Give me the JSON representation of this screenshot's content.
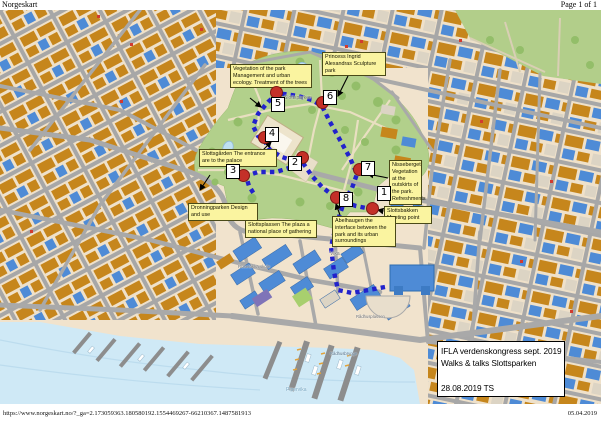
{
  "page": {
    "app_title": "Norgeskart",
    "page_indicator": "Page 1 of 1",
    "footer_url": "https://www.norgeskart.no/?_ga=2.173059363.180580192.1554469267-66210367.1487581913",
    "footer_date": "05.04.2019"
  },
  "legend": {
    "lines": [
      "IFLA verdenskongress sept. 2019",
      "Walks & talks Slottsparken",
      "",
      "28.08.2019 TS"
    ]
  },
  "map": {
    "markers": [
      {
        "number": "1",
        "circle": [
          372,
          198
        ],
        "box": [
          384,
          184
        ]
      },
      {
        "number": "2",
        "circle": [
          302,
          147
        ],
        "box": [
          295,
          154
        ]
      },
      {
        "number": "3",
        "circle": [
          243,
          165
        ],
        "box": [
          233,
          162
        ]
      },
      {
        "number": "4",
        "circle": [
          264,
          127
        ],
        "box": [
          272,
          125
        ]
      },
      {
        "number": "5",
        "circle": [
          276,
          82
        ],
        "box": [
          278,
          95
        ]
      },
      {
        "number": "6",
        "circle": [
          322,
          92
        ],
        "box": [
          330,
          88
        ]
      },
      {
        "number": "7",
        "circle": [
          359,
          159
        ],
        "box": [
          368,
          159
        ]
      },
      {
        "number": "8",
        "circle": [
          336,
          187
        ],
        "box": [
          346,
          190
        ]
      }
    ],
    "annotations": [
      {
        "id": "vegetation-of-the-park",
        "x": 230,
        "y": 54,
        "w": 82,
        "text": "Vegetation of the park Management and urban ecology.  Treatment of the trees"
      },
      {
        "id": "princess-ingrid",
        "x": 322,
        "y": 42,
        "w": 64,
        "text": "Princess Ingrid Alexandras Sculpture park"
      },
      {
        "id": "slottsgarden",
        "x": 199,
        "y": 139,
        "w": 78,
        "text": "Slottsgården The entrance are to the palace"
      },
      {
        "id": "dronningparken",
        "x": 188,
        "y": 193,
        "w": 70,
        "text": "Dronningparken Design and use"
      },
      {
        "id": "nisseberget",
        "x": 389,
        "y": 150,
        "w": 33,
        "text": "Nisseberget Vegetation at the outskirts of the park. Refreshments"
      },
      {
        "id": "slottsbakken",
        "x": 384,
        "y": 196,
        "w": 48,
        "text": "Slottsbakken Meeting point"
      },
      {
        "id": "slottsplassen",
        "x": 245,
        "y": 210,
        "w": 72,
        "text": "Slottsplassen The plaza a national place of gathering"
      },
      {
        "id": "abelhaugen",
        "x": 332,
        "y": 206,
        "w": 64,
        "text": "Abelhaugen the interface between the park and its urban surroundings"
      }
    ],
    "labels": [
      {
        "id": "slottsparken",
        "text": "Slottsparken",
        "x": 284,
        "y": 86,
        "size": 5,
        "color": "#5f7049"
      },
      {
        "id": "universitetet-i-oslo",
        "text": "Universitetet i Oslo",
        "x": 383,
        "y": 187,
        "size": 4.6,
        "color": "#4a5a6a"
      },
      {
        "id": "vika",
        "text": "Vika",
        "x": 330,
        "y": 242,
        "size": 5,
        "color": "#6b6b6b"
      },
      {
        "id": "ruselokka-skole",
        "text": "Ruseløkka skole",
        "x": 238,
        "y": 255,
        "size": 4.4,
        "color": "#6b6b6b"
      },
      {
        "id": "radhusplassen",
        "text": "Rådhusplassen",
        "x": 356,
        "y": 305,
        "size": 4.2,
        "color": "#6b6b6b"
      },
      {
        "id": "radhusbrygge",
        "text": "Rådhusbrygge",
        "x": 330,
        "y": 342,
        "size": 4.2,
        "color": "#4a6b85"
      },
      {
        "id": "pipervika",
        "text": "Pipervika",
        "x": 286,
        "y": 378,
        "size": 5,
        "color": "#6fa3c0"
      }
    ]
  },
  "colors": {
    "route_blue": "#2222cc",
    "marker_red": "#c43028",
    "note_yellow": "#faf4a0",
    "building_orange": "#c6861c",
    "building_blue": "#4e8bd6",
    "park_green": "#b2d08b",
    "water_blue": "#cfe9f6"
  }
}
